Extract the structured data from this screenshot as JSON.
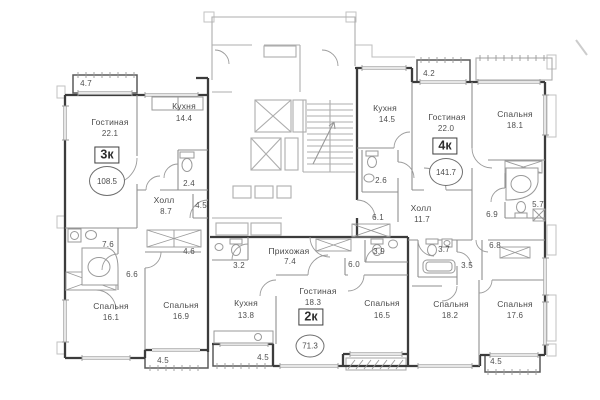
{
  "a3": {
    "label": "3к",
    "total": "108.5",
    "living": {
      "name": "Гостиная",
      "area": "22.1"
    },
    "kitchen": {
      "name": "Кухня",
      "area": "14.4"
    },
    "hall": {
      "name": "Холл",
      "area": "8.7"
    },
    "bedroom1": {
      "name": "Спальня",
      "area": "16.1"
    },
    "bedroom2": {
      "name": "Спальня",
      "area": "16.9"
    },
    "wc": "2.4",
    "bath": "7.6",
    "corridor": "6.6",
    "wardrobe": "4.6",
    "storage": "4.5",
    "balcony_top": "4.7",
    "balcony_bottom": "4.5"
  },
  "a2": {
    "label": "2к",
    "total": "71.3",
    "entry": {
      "name": "Прихожая",
      "area": "7.4"
    },
    "kitchen": {
      "name": "Кухня",
      "area": "13.8"
    },
    "living": {
      "name": "Гостиная",
      "area": "18.3"
    },
    "bedroom": {
      "name": "Спальня",
      "area": "16.5"
    },
    "bath": "3.2",
    "wc": "3.9",
    "corridor": "6.0",
    "balcony": "4.5"
  },
  "a4": {
    "label": "4к",
    "total": "141.7",
    "kitchen": {
      "name": "Кухня",
      "area": "14.5"
    },
    "living": {
      "name": "Гостиная",
      "area": "22.0"
    },
    "hall": {
      "name": "Холл",
      "area": "11.7"
    },
    "bedroom1": {
      "name": "Спальня",
      "area": "18.1"
    },
    "bedroom2": {
      "name": "Спальня",
      "area": "18.2"
    },
    "bedroom3": {
      "name": "Спальня",
      "area": "17.6"
    },
    "wc1": "2.6",
    "corridor1": "6.1",
    "corridor2": "6.9",
    "bath": "5.7",
    "storage1": "6.8",
    "wc2": "3.7",
    "storage2": "3.5",
    "balcony_top": "4.2",
    "balcony_bottom": "4.5"
  },
  "colors": {
    "wall": "#3c3c3c",
    "thin": "#8f8f8f",
    "core": "#adadad",
    "text": "#4a4a4a"
  }
}
